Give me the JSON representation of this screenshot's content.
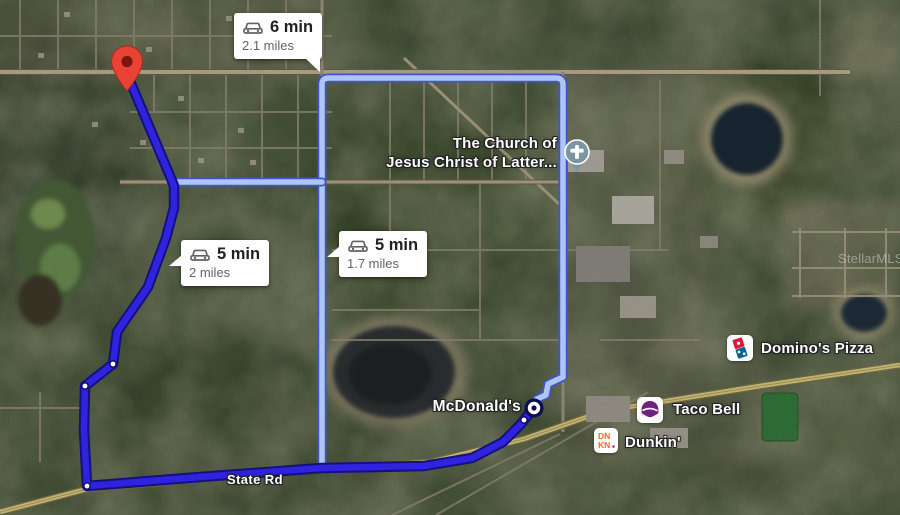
{
  "bubbles": [
    {
      "duration": "6 min",
      "distance": "2.1 miles",
      "mode": "drive"
    },
    {
      "duration": "5 min",
      "distance": "2 miles",
      "mode": "drive"
    },
    {
      "duration": "5 min",
      "distance": "1.7 miles",
      "mode": "drive"
    }
  ],
  "labels": {
    "church_line1": "The Church of",
    "church_line2": "Jesus Christ of Latter...",
    "mcdonalds": "McDonald's",
    "dominos": "Domino's Pizza",
    "taco_bell": "Taco Bell",
    "dunkin": "Dunkin'",
    "state_road": "State Rd",
    "watermark": "StellarMLS"
  },
  "icons": {
    "origin_pin": "red-map-pin",
    "destination_marker": "white-ringed-circle",
    "church": "cross-in-circle-pin",
    "dominos": "dominos-domino-logo",
    "taco_bell": "taco-bell-bell-logo",
    "dunkin": "dunkin-dn-kn-logo",
    "car": "car-front-icon"
  },
  "colors": {
    "primary-route": "#2f23dd",
    "primary-route-casing": "#151080",
    "alt-route": "#aec6f7",
    "alt-route-casing": "#4355c6",
    "pin-red": "#e94335",
    "church-icon": "#7b95a4",
    "dominos-red": "#e31837",
    "dominos-blue": "#006491",
    "taco-bell-purple": "#702082",
    "dunkin-orange": "#ff671f",
    "dunkin-pink": "#da1884",
    "highway-yellow": "#e7d78e",
    "bubble-text": "#202124",
    "bubble-subtext": "#5f6368"
  }
}
